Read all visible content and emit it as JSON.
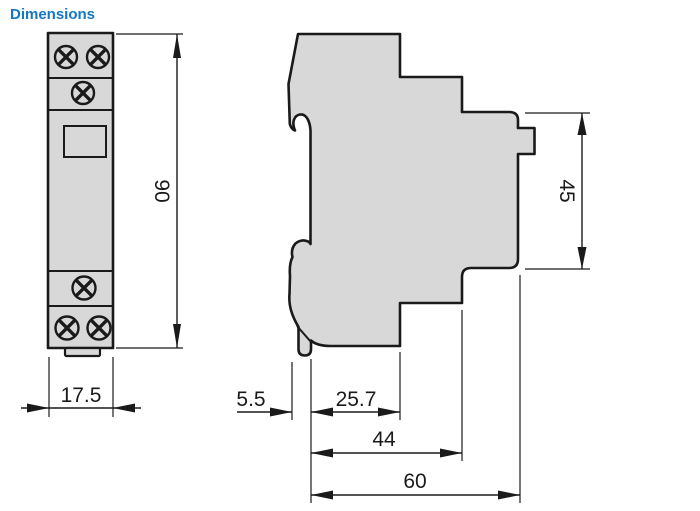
{
  "title": "Dimensions",
  "colors": {
    "title": "#1478be",
    "body_fill": "#d8d8d8",
    "line": "#1a1a1a"
  },
  "front_view": {
    "width_mm": "17.5",
    "height_mm": "90"
  },
  "side_view": {
    "clip_depth_mm": "5.5",
    "upper_body_depth_mm": "25.7",
    "body_depth_mm": "44",
    "total_depth_mm": "60",
    "rear_height_mm": "45"
  }
}
